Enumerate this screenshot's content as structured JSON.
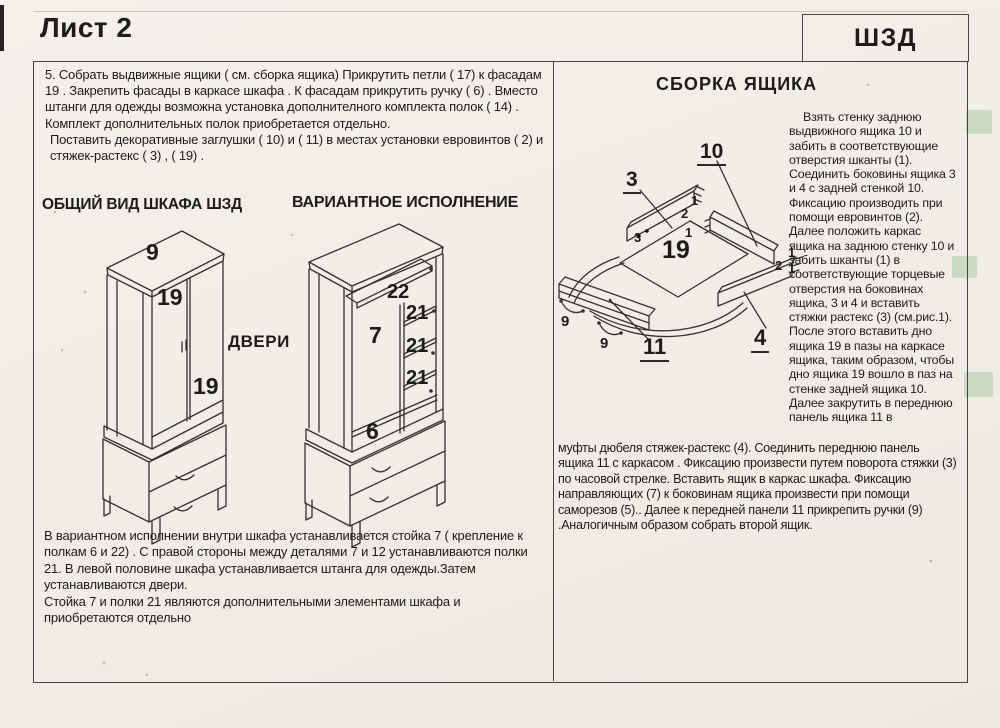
{
  "header": {
    "sheet": "Лист 2",
    "code": "ШЗД"
  },
  "left_column": {
    "paragraph_5a": "5. Собрать выдвижные ящики  ( см. сборка ящика)   Прикрутить петли  ( 17)   к фасадам 19 . Закрепить фасады в каркасе шкафа . К фасадам прикрутить ручку ( 6)  . Вместо штанги для одежды   возможна установка дополнителного комплекта  полок   ( 14)  . Комплект дополнительных полок приобретается отдельно.",
    "paragraph_5b": "Поставить декоративные заглушки  ( 10)   и  ( 11)   в местах установки евровинтов  ( 2)   и стяжек-растекс  ( 3)  ,  ( 19)  .",
    "heading_general_view": "ОБЩИЙ ВИД ШКАФА ШЗД",
    "heading_variant": "ВАРИАНТНОЕ ИСПОЛНЕНИЕ",
    "variant_note_1": "В вариантном исполнении внутри шкафа устанавливается стойка 7 ( крепление к полкам 6 и 22)  . С правой стороны между деталями 7 и 12 устанавливаются полки 21.  В левой половине шкафа устанавливается штанга для одежды.Затем устанавливаются двери.",
    "variant_note_2": "Стойка 7 и полки 21 являются дополнительными элементами шкафа и приобретаются отдельно"
  },
  "right_column": {
    "heading_drawer_assembly": "СБОРКА ЯЩИКА",
    "assembly_text": "Взять стенку заднюю выдвижного ящика 10 и забить в соответствующие отверстия шканты (1). Соединить боковины ящика 3 и 4 с задней стенкой 10. Фиксацию производить при помощи евровинтов (2). Далее положить каркас ящика на заднюю стенку 10  и забить шканты (1) в соответствующие  торцевые отверстия на боковинах ящика, 3 и 4 и вставить стяжки растекс (3) (см.рис.1). После этого вставить дно ящика 19 в пазы на каркасе ящика, таким образом, чтобы дно ящика 19  вошло в паз на стенке задней ящика 10. Далее закрутить в переднюю панель ящика 11 в",
    "assembly_text_bottom": "муфты дюбеля стяжек-растекс (4). Соединить переднюю панель ящика  11 с каркасом . Фиксацию произвести путем поворота стяжки (3) по часовой стрелке. Вставить ящик в каркас шкафа. Фиксацию направляющих (7) к боковинам ящика произвести при помощи саморезов (5).. Далее к передней панели 11 прикрепить ручки  (9) .Аналогичным образом собрать второй ящик."
  },
  "labels": {
    "doors": "ДВЕРИ",
    "wg_top_panel": "9",
    "wg_left_door": "19",
    "wg_right_door": "19",
    "wv_top_shelf": "22",
    "wv_stand": "7",
    "wv_shelf_1": "21",
    "wv_shelf_2": "21",
    "wv_shelf_3": "21",
    "wv_bottom_shelf": "6",
    "da_back_wall": "10",
    "da_side_left": "3",
    "da_bottom_panel": "19",
    "da_front_panel": "11",
    "da_side_right": "4",
    "da_handle_1": "9",
    "da_handle_2": "9",
    "da_pin_left_1": "1",
    "da_pin_left_2": "2",
    "da_pin_left_3": "1",
    "da_hole_left": "3",
    "da_pin_right_1": "1",
    "da_pin_right_2": "2",
    "da_pin_right_3": "1"
  },
  "colors": {
    "paper": "#f2efe9",
    "ink": "#1d1c1a",
    "line": "#45443e",
    "highlight_green": "#accaa7"
  }
}
